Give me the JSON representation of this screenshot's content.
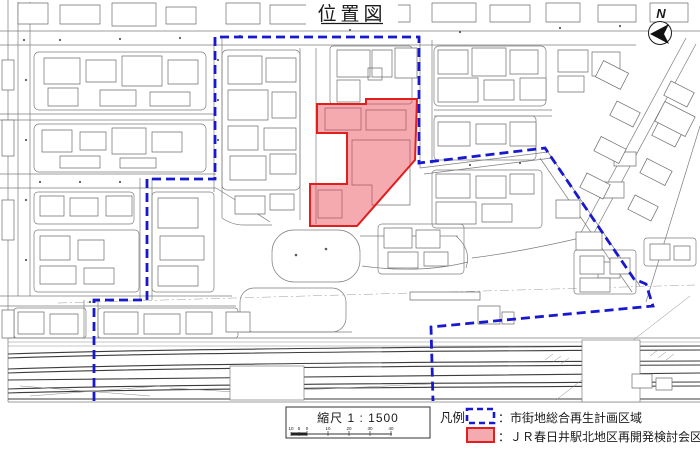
{
  "title": "位置図",
  "compass": {
    "label": "N"
  },
  "scale_box": {
    "label": "縮尺 1 : 1500",
    "ticks": [
      "10",
      "5",
      "0",
      "10",
      "20",
      "30",
      "40"
    ]
  },
  "legend": {
    "heading": "凡例",
    "items": [
      {
        "label": "：市街地総合再生計画区域"
      },
      {
        "label": "：ＪＲ春日井駅北地区再開発検討会区域"
      }
    ]
  },
  "colors": {
    "boundary_blue": "#1818cf",
    "area_red_stroke": "#e01f1f",
    "area_red_fill": "#e8424f",
    "map_line": "#7d7d7d",
    "rail_line": "#3c3c3c"
  },
  "boundary_blue_region": {
    "points": "94,401 94,300 147,300 147,179 215,179 215,37 419,37 419,163 545,148 634,279 646,284 653,306 431,327 433,401"
  },
  "redevelopment_area": {
    "points": "317,104 366,104 366,99 417,99 415,160 357,226 310,226 310,184 347,184 347,133 317,133"
  }
}
